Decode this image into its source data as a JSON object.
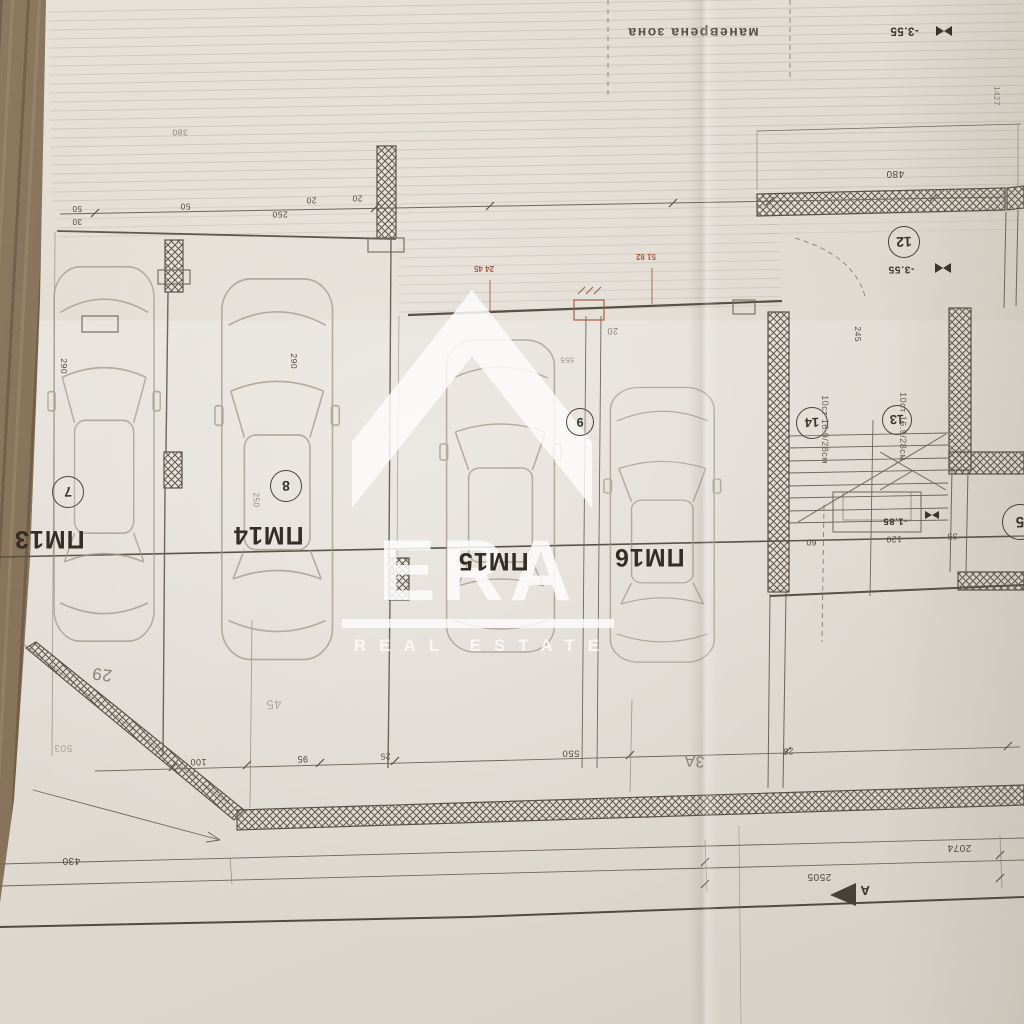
{
  "colors": {
    "paper": "#e5e0d9",
    "wood": "#7c6750",
    "ink": "#5f584d",
    "red_annotation": "#a85c4a",
    "watermark_white": "#fdfdfb"
  },
  "watermark": {
    "brand": "ERA",
    "tagline": "REAL ESTATE"
  },
  "plan": {
    "zone_label": "маневрена зона",
    "spaces": [
      {
        "label": "ПМ13",
        "stall_number": "7"
      },
      {
        "label": "ПМ14",
        "stall_number": "8"
      },
      {
        "label": "ПМ15",
        "stall_number": "9"
      },
      {
        "label": "ПМ16",
        "stall_number": ""
      }
    ],
    "rooms": [
      {
        "number": "12"
      },
      {
        "number": "14"
      },
      {
        "number": "13"
      },
      {
        "number": "5"
      }
    ],
    "levels": {
      "ramp_top": "-3.55",
      "stair_mid": "-3.55",
      "stair_low": "-1.85"
    },
    "stairs": {
      "note": "10ст 16.9/28см"
    },
    "section": {
      "marker": "A"
    },
    "dims": {
      "d480": "480",
      "d245": "245",
      "d60": "60",
      "d120": "120",
      "d35": "35",
      "d550": "550",
      "d100": "100",
      "d95": "95",
      "d25": "25",
      "d2074": "2074",
      "d2505": "2505",
      "d430": "430",
      "d290": "290",
      "d250": "250",
      "d50": "50",
      "d20": "20",
      "d30": "30",
      "d380": "380",
      "d1427": "1427",
      "d555": "555"
    },
    "handwritten": {
      "h29": "29",
      "h45": "45",
      "h3a": "3A",
      "h503": "503"
    },
    "red_marks": [
      {
        "line1": "24",
        "line2": "45"
      },
      {
        "line1": "51",
        "line2": "82"
      }
    ]
  }
}
